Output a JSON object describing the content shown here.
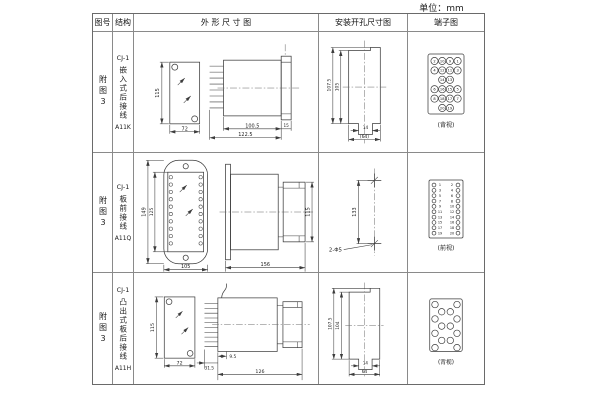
{
  "unit_label": "单位：mm",
  "table": {
    "headers": [
      "图号",
      "结构",
      "外 形 尺 寸 图",
      "安装开孔尺寸图",
      "端子图"
    ]
  },
  "rows": [
    {
      "fig_no": "附图3",
      "model": "CJ-1",
      "name": "嵌入式后接线",
      "code": "A11K",
      "outline": {
        "height": "115",
        "width": "72",
        "body_len": "100.5",
        "total_len": "122.5",
        "flange": "15"
      },
      "install": {
        "outer_h": "107.5",
        "inner_h": "105",
        "slot_w": "14",
        "overall_w": "(64)"
      },
      "terminal": {
        "style": "grid4",
        "view_label": "(背视)",
        "rows": [
          [
            "2",
            "10",
            "9",
            "1"
          ],
          [
            "4",
            "12",
            "11",
            "3"
          ],
          [
            "",
            "14",
            "13",
            ""
          ],
          [
            "6",
            "16",
            "15",
            "5"
          ],
          [
            "8",
            "18",
            "17",
            "7"
          ],
          [
            "",
            "20",
            "19",
            ""
          ]
        ]
      }
    },
    {
      "fig_no": "附图3",
      "model": "CJ-1",
      "name": "板前接线",
      "code": "A11Q",
      "outline": {
        "outer_h": "149",
        "inner_h": "125",
        "width": "105",
        "side_len": "156",
        "side_h": "115"
      },
      "install": {
        "pitch": "133",
        "holes": "2-Φ5"
      },
      "terminal": {
        "style": "pairs",
        "view_label": "(前视)",
        "left": [
          "1",
          "3",
          "5",
          "7",
          "9",
          "11",
          "13",
          "15",
          "17",
          "19"
        ],
        "right": [
          "2",
          "4",
          "6",
          "8",
          "10",
          "12",
          "14",
          "16",
          "18",
          "20"
        ]
      }
    },
    {
      "fig_no": "附图3",
      "model": "CJ-1",
      "name": "凸出式板后接线",
      "code": "A11H",
      "outline": {
        "height": "115",
        "width": "72",
        "comb_len": "31.5",
        "stud": "9.5",
        "body_len": "126"
      },
      "install": {
        "outer_h": "107.5",
        "inner_h": "104",
        "slot_w": "14",
        "overall_w": "64"
      },
      "terminal": {
        "style": "staggered",
        "view_label": "(背视)"
      }
    }
  ]
}
